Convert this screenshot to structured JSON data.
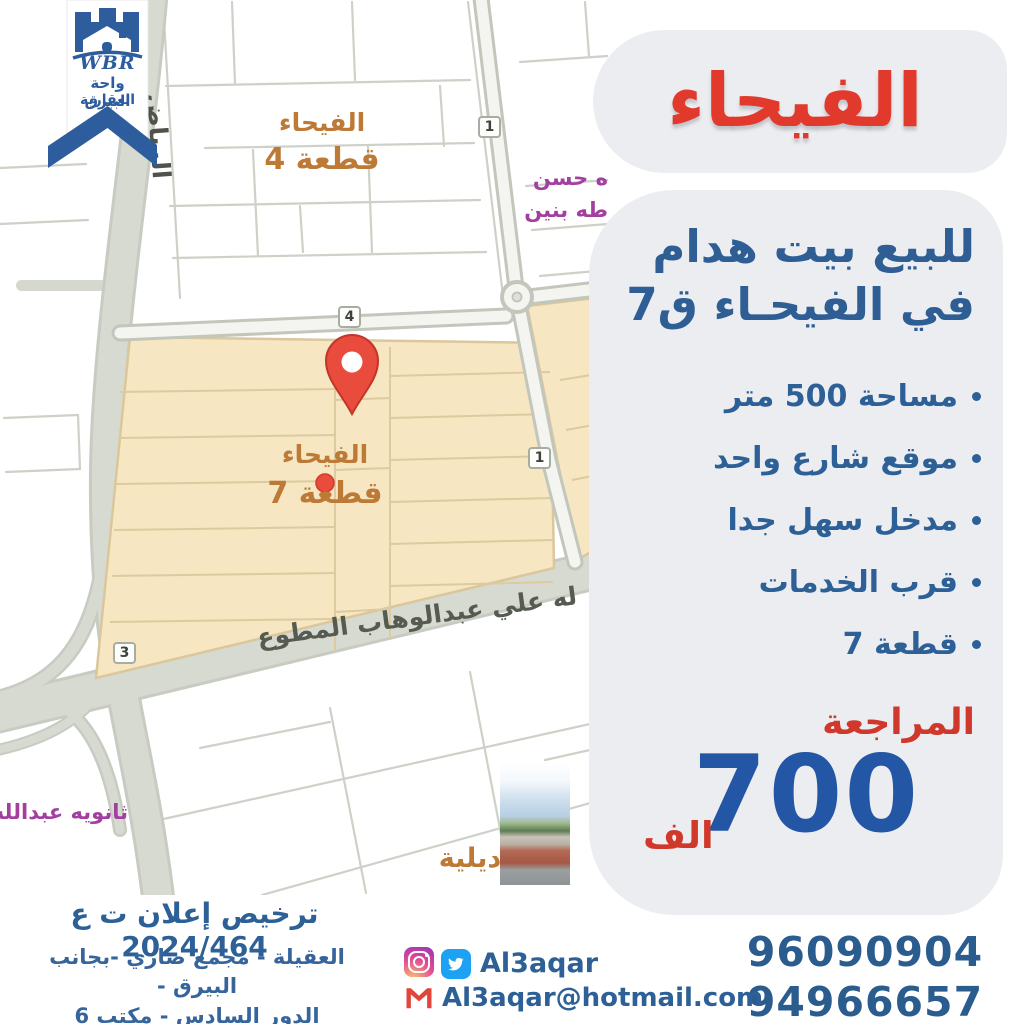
{
  "brand": {
    "initials": "WBR",
    "line1": "واحة البيرق",
    "line2": "العقارية"
  },
  "headline": "الفيحاء",
  "offer": {
    "line1": "للبيع بيت هدام",
    "line2": "في الفيحـاء ق7"
  },
  "features": [
    "مساحة 500 متر",
    "موقع شارع واحد",
    "مدخل سهل جدا",
    "قرب الخدمات",
    "قطعة 7"
  ],
  "price": {
    "label": "المراجعة",
    "amount": "700",
    "unit": "الف"
  },
  "phones": [
    "96090904",
    "94966657"
  ],
  "footer": {
    "license": "ترخيص إعلان ت ع 2024/464",
    "address_line1": "العقيلة - مجمع ضاري -بجانب البيرق -",
    "address_line2": "الدور السادس - مكتب 6"
  },
  "social": {
    "handle": "Al3aqar",
    "email": "Al3aqar@hotmail.com"
  },
  "map": {
    "block4": {
      "line1": "الفيحاء",
      "line2": "قطعة 4"
    },
    "block7": {
      "line1": "الفيحاء",
      "line2": "قطعة 7"
    },
    "school_top": {
      "line1": "ه حسن",
      "line2": "طه بنين"
    },
    "school_bottom": "ثانويه عبدالله",
    "district_partial": "ديلية",
    "street_main": "له علي عبدالوهاب المطوع",
    "street_left": "الرياض",
    "badges": {
      "top": "1",
      "middle": "4",
      "right": "1",
      "bottom": "3"
    }
  },
  "colors": {
    "headline_red": "#e2392d",
    "accent_blue": "#2e5e94",
    "price_blue": "#2356a5",
    "pill_gray": "#ecedf0",
    "block_beige": "#f6e6c1",
    "pin_red": "#e94b3d"
  }
}
